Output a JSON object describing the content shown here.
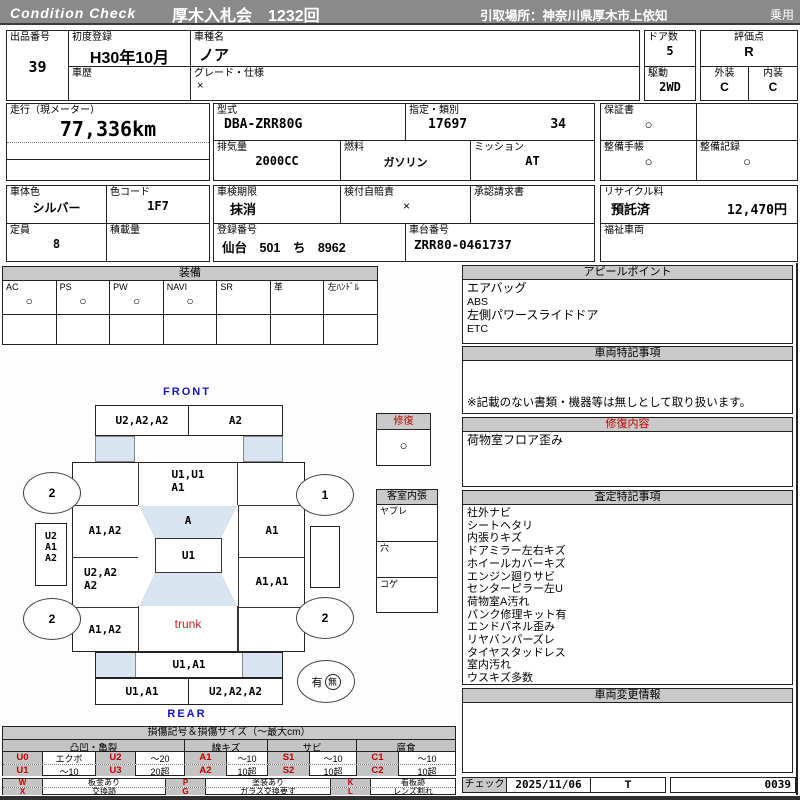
{
  "header": {
    "brand": "Condition  Check",
    "auction_title": "厚木入札会　1232回",
    "pickup": "引取場所：神奈川県厚木市上依知",
    "category": "乗用"
  },
  "info": {
    "lot_label": "出品番号",
    "lot_no": "39",
    "first_reg_label": "初度登録",
    "first_reg": "H30年10月",
    "history_label": "車歴",
    "model_name_label": "車種名",
    "model_name": "ノア",
    "grade_label": "グレード・仕様",
    "grade": "×",
    "doors_label": "ドア数",
    "doors": "5",
    "score_label": "評価点",
    "score": "R",
    "drive_label": "駆動",
    "drive": "2WD",
    "exterior_label": "外装",
    "exterior": "C",
    "interior_label": "内装",
    "interior": "C",
    "mileage_label": "走行（現メーター）",
    "mileage": "77,336km",
    "model_code_label": "型式",
    "model_code": "DBA-ZRR80G",
    "type_class_label": "指定・類別",
    "type_no": "17697",
    "class_no": "34",
    "displacement_label": "排気量",
    "displacement": "2000CC",
    "fuel_label": "燃料",
    "fuel": "ガソリン",
    "mission_label": "ミッション",
    "mission": "AT",
    "warranty_label": "保証書",
    "warranty": "○",
    "book_label": "整備手帳",
    "book": "○",
    "record_label": "整備記録",
    "record": "○",
    "color_label": "車体色",
    "color": "シルバー",
    "color_code_label": "色コード",
    "color_code": "1F7",
    "inspection_label": "車検期限",
    "inspection": "抹消",
    "insurance_label": "検付自賠責",
    "insurance": "×",
    "approval_label": "承認請求書",
    "capacity_label": "定員",
    "capacity": "8",
    "load_label": "積載量",
    "reg_label": "登録番号",
    "reg_no": "仙台　501　ち　8962",
    "chassis_label": "車台番号",
    "chassis_no": "ZRR80-0461737",
    "recycle_label": "リサイクル料",
    "recycle_status": "預託済",
    "recycle_fee": "12,470円",
    "welfare_label": "福祉車両"
  },
  "equipment": {
    "title": "装備",
    "items": [
      {
        "label": "AC",
        "value": "○"
      },
      {
        "label": "PS",
        "value": "○"
      },
      {
        "label": "PW",
        "value": "○"
      },
      {
        "label": "NAVI",
        "value": "○"
      },
      {
        "label": "SR",
        "value": ""
      },
      {
        "label": "革",
        "value": ""
      },
      {
        "label": "左ﾊﾝﾄﾞﾙ",
        "value": ""
      }
    ]
  },
  "panels": {
    "appeal": {
      "title": "アピールポイント",
      "lines": [
        "エアバッグ",
        "ABS",
        "左側パワースライドドア",
        "ETC"
      ]
    },
    "special": {
      "title": "車両特記事項",
      "note": "※記載のない書類・機器等は無しとして取り扱います。"
    },
    "repair": {
      "title": "修復内容",
      "lines": [
        "荷物室フロア歪み"
      ]
    },
    "assessment": {
      "title": "査定特記事項",
      "lines": [
        "社外ナビ",
        "シートヘタリ",
        "内張りキズ",
        "ドアミラー左右キズ",
        "ホイールカバーキズ",
        "エンジン廻りサビ",
        "センターピラー左U",
        "荷物室A汚れ",
        "パンク修理キット有",
        "エンドパネル歪み",
        "リヤバンパーズレ",
        "タイヤスタッドレス",
        "室内汚れ",
        "ウスキズ多数"
      ]
    },
    "change": {
      "title": "車両変更情報"
    }
  },
  "diagram": {
    "front_label": "FRONT",
    "rear_label": "REAR",
    "front_bumper_left": "U2,A2,A2",
    "front_bumper_right": "A2",
    "hood_line1": "U1,U1",
    "hood_line2": "A1",
    "windshield": "A",
    "roof": "U1",
    "trunk_label": "trunk",
    "mirror_left_1": "U2",
    "mirror_left_2": "A1",
    "mirror_left_3": "A2",
    "left_front_door": "A1,A2",
    "left_slide_door_line1": "U2,A2",
    "left_slide_door_line2": "A2",
    "left_quarter": "A1,A2",
    "right_front": "A1",
    "right_side": "A1,A1",
    "tailgate": "U1,A1",
    "rear_bumper_left": "U1,A1",
    "rear_bumper_right": "U2,A2,A2",
    "wheel_front_left": "2",
    "wheel_front_right": "1",
    "wheel_rear_left": "2",
    "wheel_rear_right": "2",
    "repair_mark_title": "修復",
    "repair_mark_value": "○",
    "cabin_title": "客室内張",
    "cabin_row_1": "ヤブレ",
    "cabin_row_2": "穴",
    "cabin_row_3": "コゲ",
    "spare_yes": "有",
    "spare_no": "無"
  },
  "legend": {
    "title": "損傷記号＆損傷サイズ（〜最大cm）",
    "groups": [
      "凸凹・亀裂",
      "線キズ",
      "サビ",
      "腐食"
    ],
    "rows": [
      [
        "U0",
        "エクボ",
        "U2",
        "〜20",
        "A1",
        "〜10",
        "S1",
        "〜10",
        "C1",
        "〜10"
      ],
      [
        "U1",
        "〜10",
        "U3",
        "20超",
        "A2",
        "10超",
        "S2",
        "10超",
        "C2",
        "10超"
      ]
    ],
    "marks": [
      [
        "W",
        "板金あり",
        "P",
        "塗装あり",
        "K",
        "看板跡"
      ],
      [
        "X",
        "交換跡",
        "G",
        "ガラス交換要す",
        "L",
        "レンズ割れ"
      ]
    ]
  },
  "footer": {
    "check_label": "チェック",
    "date": "2025/11/06",
    "inspector": "T",
    "sheet_no": "0039"
  }
}
